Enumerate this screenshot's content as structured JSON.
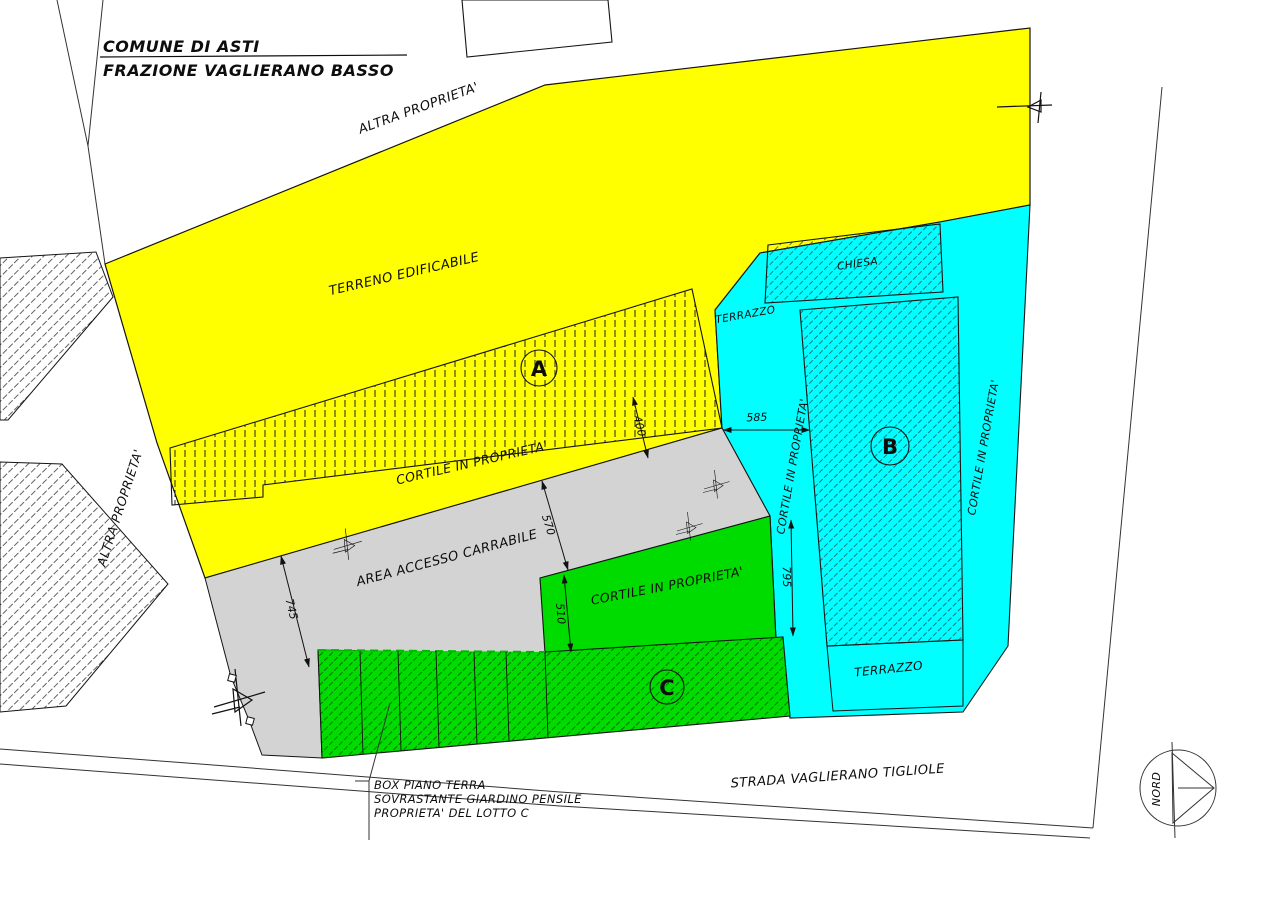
{
  "drawing": {
    "title_line1": "COMUNE DI ASTI",
    "title_line2": "FRAZIONE VAGLIERANO BASSO",
    "road_label": "STRADA VAGLIERANO TIGLIOLE",
    "north_label": "NORD"
  },
  "parcels": {
    "lot_a_letter": "A",
    "lot_b_letter": "B",
    "lot_c_letter": "C",
    "terreno_edificabile": "TERRENO EDIFICABILE",
    "altra_proprieta_top": "ALTRA PROPRIETA'",
    "altra_proprieta_left": "ALTRA PROPRIETA'",
    "cortile_yellow": "CORTILE IN PROPRIETA'",
    "cortile_green": "CORTILE IN PROPRIETA'",
    "cortile_cyan_left": "CORTILE IN PROPRIETA'",
    "cortile_cyan_right": "CORTILE IN PROPRIETA'",
    "area_accesso": "AREA ACCESSO CARRABILE",
    "chiesa": "CHIESA",
    "terrazzo_upper": "TERRAZZO",
    "terrazzo_lower": "TERRAZZO"
  },
  "dimensions": {
    "a_cortile": "400",
    "b_strip": "585",
    "access_width": "570",
    "green_width": "510",
    "access_length": "745",
    "b_side": "795"
  },
  "legend_note": {
    "line1": "BOX PIANO TERRA",
    "line2": "SOVRASTANTE GIARDINO PENSILE",
    "line3": "PROPRIETA' DEL LOTTO C"
  },
  "colors": {
    "yellow": "#FFFF00",
    "cyan": "#00FFFF",
    "green": "#00DB00",
    "gray": "#D3D3D3",
    "white": "#FFFFFF",
    "line": "#141414"
  }
}
